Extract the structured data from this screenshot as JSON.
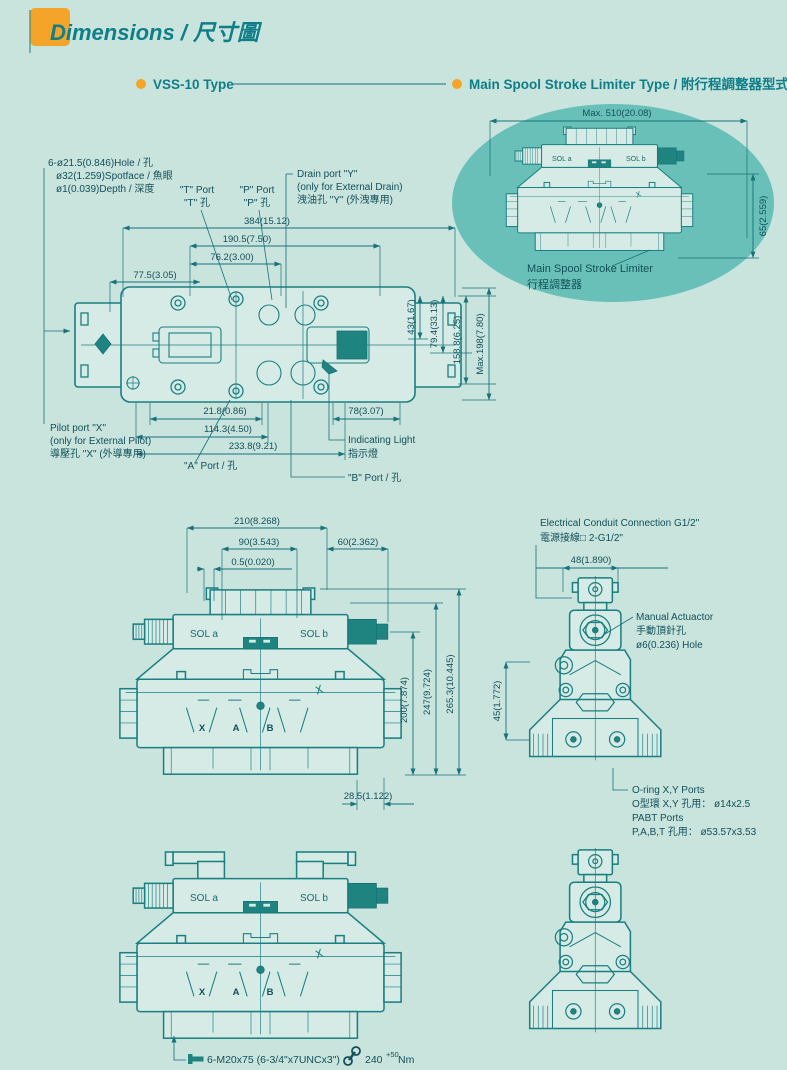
{
  "page": {
    "title": "Dimensions / 尺寸圖"
  },
  "sections": {
    "left": "VSS-10 Type",
    "right": "Main Spool Stroke Limiter Type / 附行程調整器型式"
  },
  "oval": {
    "dim_w": "Max. 510(20.08)",
    "dim_h": "65(2.559)",
    "label1": "Main Spool Stroke Limiter",
    "label2": "行程調整器"
  },
  "sol": {
    "a": "SOL a",
    "b": "SOL b"
  },
  "ports": {
    "x": "X",
    "a": "A",
    "b": "B"
  },
  "top_view": {
    "dims": {
      "w_384": "384(15.12)",
      "w_190": "190.5(7.50)",
      "w_76": "76.2(3.00)",
      "w_77": "77.5(3.05)",
      "h_43": "43(1.67)",
      "h_79": "79.4(33.13)",
      "h_158": "158.8(6.25)",
      "h_198": "Max.198(7.80)",
      "b_21": "21.8(0.86)",
      "b_114": "114.3(4.50)",
      "b_233": "233.8(9.21)",
      "b_78": "78(3.07)"
    },
    "labels": {
      "hole1": "6-ø21.5(0.846)Hole / 孔",
      "hole2": "ø32(1.259)Spotface / 魚眼",
      "hole3": "ø1(0.039)Depth / 深度",
      "t1": "\"T\" Port",
      "t2": "\"T\" 孔",
      "p1": "\"P\" Port",
      "p2": "\"P\" 孔",
      "drain1": "Drain port \"Y\"",
      "drain2": "(only for External Drain)",
      "drain3": "洩油孔 \"Y\" (外洩專用)",
      "pilot1": "Pilot port \"X\"",
      "pilot2": "(only for External Pilot)",
      "pilot3": "導壓孔 \"X\" (外導專用)",
      "a_port": "\"A\" Port / 孔",
      "b_port": "\"B\" Port / 孔",
      "ind1": "Indicating Light",
      "ind2": "指示燈"
    }
  },
  "front_view": {
    "dims": {
      "w_210": "210(8.268)",
      "w_90": "90(3.543)",
      "w_60": "60(2.362)",
      "w_05": "0.5(0.020)",
      "h_200": "200(7.874)",
      "h_247": "247(9.724)",
      "h_265": "265.3(10.445)",
      "b_28": "28.5(1.122)"
    }
  },
  "side_view": {
    "dims": {
      "w_48": "48(1.890)",
      "h_45": "45(1.772)"
    },
    "labels": {
      "cond1": "Electrical Conduit Connection G1/2\"",
      "cond2": "電源接線□ 2-G1/2\"",
      "man1": "Manual Actuactor",
      "man2": "手動頂針孔",
      "man3": "ø6(0.236) Hole",
      "oring1": "O-ring X,Y Ports",
      "oring2": "O型環 X,Y 孔用： ø14x2.5",
      "oring3": "PABT Ports",
      "oring4": "P,A,B,T 孔用： ø53.57x3.53"
    }
  },
  "footer": {
    "bolt": "6-M20x75 (6-3/4\"x7UNCx3\")",
    "torque": "240",
    "torque_sup": "+50",
    "torque_unit": "Nm"
  }
}
